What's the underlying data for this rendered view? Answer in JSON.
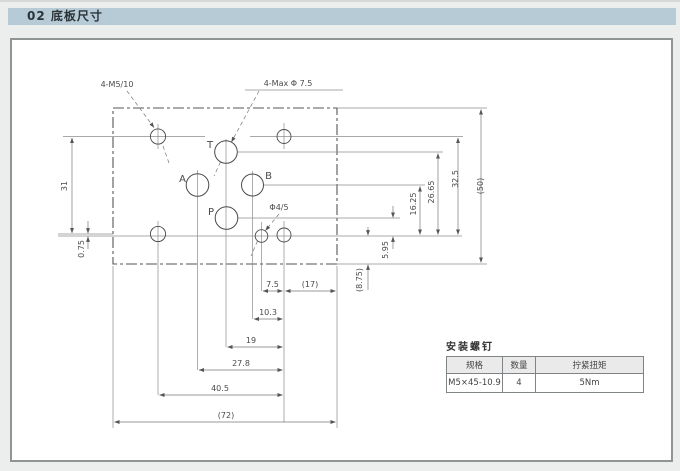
{
  "page": {
    "header_title": "02 底板尺寸"
  },
  "drawing": {
    "callouts": {
      "mounting_holes": "4-M5/10",
      "max_ports": "4-Max Φ 7.5",
      "pin_hole": "Φ4/5"
    },
    "port_labels": {
      "t": "T",
      "a": "A",
      "b": "B",
      "p": "P"
    },
    "dimensions": {
      "d7_5": "7.5",
      "d17": "(17)",
      "d10_3": "10.3",
      "d19": "19",
      "d27_8": "27.8",
      "d40_5": "40.5",
      "d72": "(72)",
      "d31": "31",
      "d0_75": "0.75",
      "d5_95": "5.95",
      "d8_75": "(8.75)",
      "d16_25": "16.25",
      "d26_65": "26.65",
      "d32_5": "32.5",
      "d50": "(50)"
    }
  },
  "screw_table": {
    "title": "安装螺钉",
    "headers": [
      "规格",
      "数量",
      "拧紧扭矩"
    ],
    "rows": [
      [
        "M5×45-10.9",
        "4",
        "5Nm"
      ]
    ]
  },
  "colors": {
    "header_bar": "#b7cbd7",
    "drawing_line": "#777777",
    "plate_outline": "#555555"
  }
}
